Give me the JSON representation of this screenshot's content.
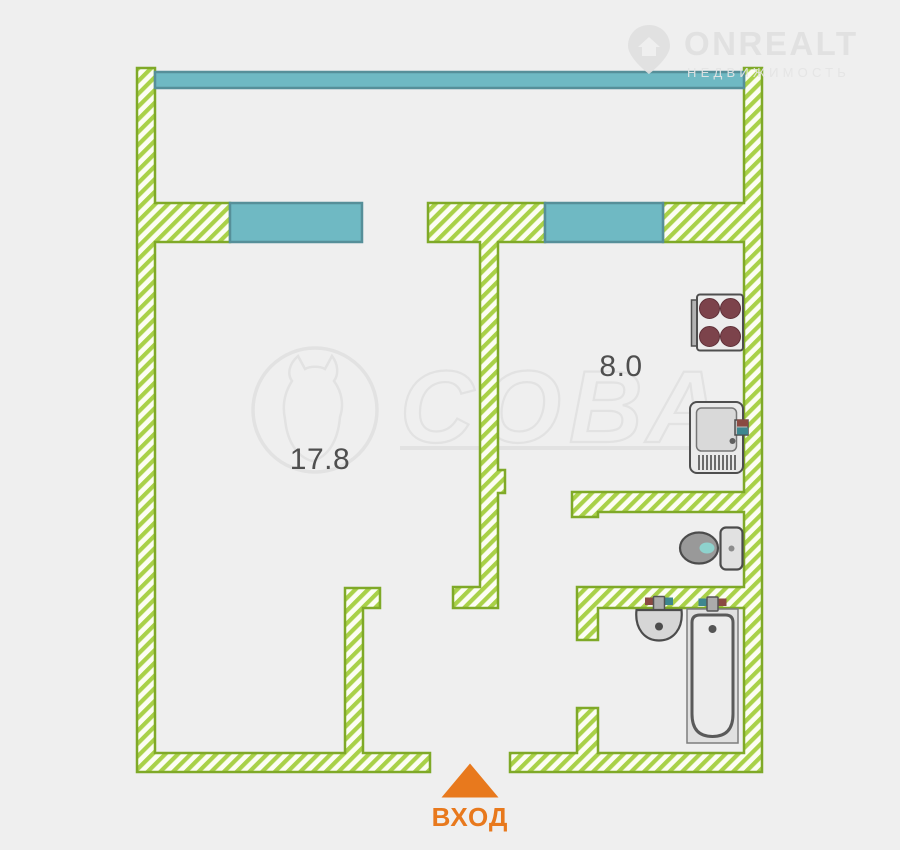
{
  "watermarks": {
    "onrealt": {
      "brand": "ONREALT",
      "subtitle": "НЕДВИЖИМОСТЬ"
    },
    "sova": {
      "text": "СОВА"
    }
  },
  "floor_plan": {
    "room_labels": {
      "living": "17.8",
      "kitchen": "8.0"
    },
    "entrance_label": "ВХОД",
    "colors": {
      "background": "#efefef",
      "wall_hatch_green": "#a9d148",
      "wall_border_green": "#7fa928",
      "wall_fill": "#fcfdf3",
      "window_teal": "#6fb9c3",
      "window_border": "#568f99",
      "entrance_orange": "#e8791d",
      "burner_maroon": "#7c434b",
      "fixture_outline_gray": "#4f4f4f",
      "hot_tap_red": "#8a4a42",
      "cold_tap_teal": "#3e878f",
      "toilet_water_teal": "#8ed2cd",
      "watermark_gray": "#e2e2e2",
      "label_gray": "#4f4f4f"
    }
  }
}
